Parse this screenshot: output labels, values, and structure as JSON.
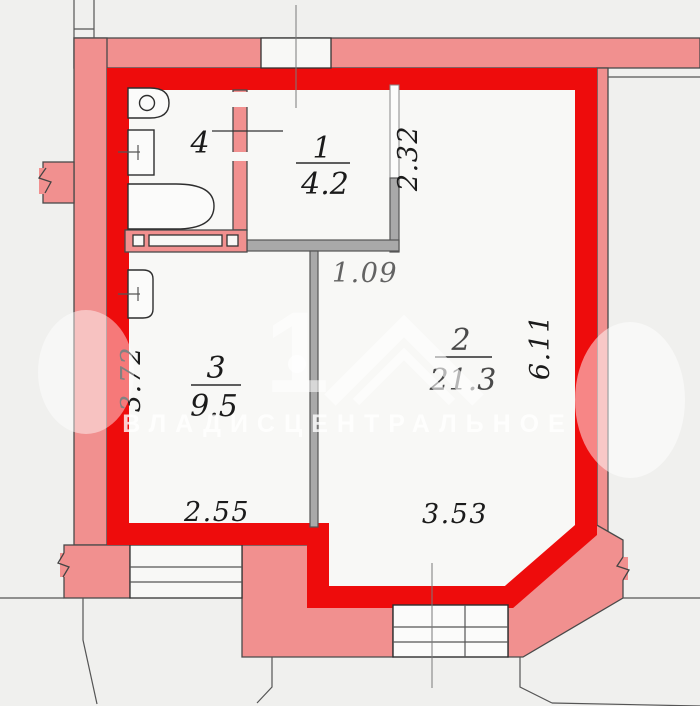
{
  "plan": {
    "rooms": [
      {
        "number": "1",
        "area": "4.2"
      },
      {
        "number": "2",
        "area": "21.3"
      },
      {
        "number": "3",
        "area": "9.5"
      },
      {
        "number": "4",
        "area": ""
      }
    ],
    "dimensions": {
      "room1_height": "2.32",
      "hall_width": "1.09",
      "room2_height": "6.11",
      "room3_height": "3.72",
      "room3_width": "2.55",
      "room2_width": "3.53"
    },
    "watermark": {
      "digit": "1",
      "agency": "ВЛАДИСЦЕНТРАЛЬНОЕ"
    },
    "colors": {
      "wall_red": "#ee0c0c",
      "wall_pink": "#f1908f",
      "wall_gray": "#a9a9a9",
      "floor": "#f8f8f6",
      "background": "#f0f0ee"
    }
  }
}
